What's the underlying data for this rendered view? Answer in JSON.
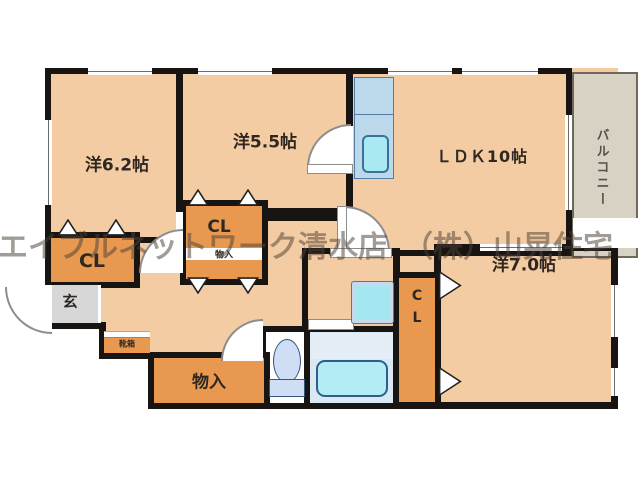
{
  "watermark": "エイブルネットワーク清水店　（株）山晃住宅",
  "labels": {
    "western62": "洋6.2帖",
    "western55": "洋5.5帖",
    "ldk": "ＬＤＫ10帖",
    "western70": "洋7.0帖",
    "balcony": "バルコニー",
    "closet_left": "CL",
    "closet_mid": "CL",
    "storage_mid": "物入",
    "storage_bottom": "物入",
    "closet_right": "CL",
    "entrance": "玄",
    "shoe_cabinet": "靴箱"
  },
  "colors": {
    "wall": "#171411",
    "floor": "#f4cca3",
    "closet": "#e8994f",
    "fixture_water": "#a8e9f2",
    "counter": "#bcd9ec",
    "bathroom": "#d9e8f3",
    "balcony": "#d8d2c5",
    "entrance_floor": "#d7d7d7"
  }
}
